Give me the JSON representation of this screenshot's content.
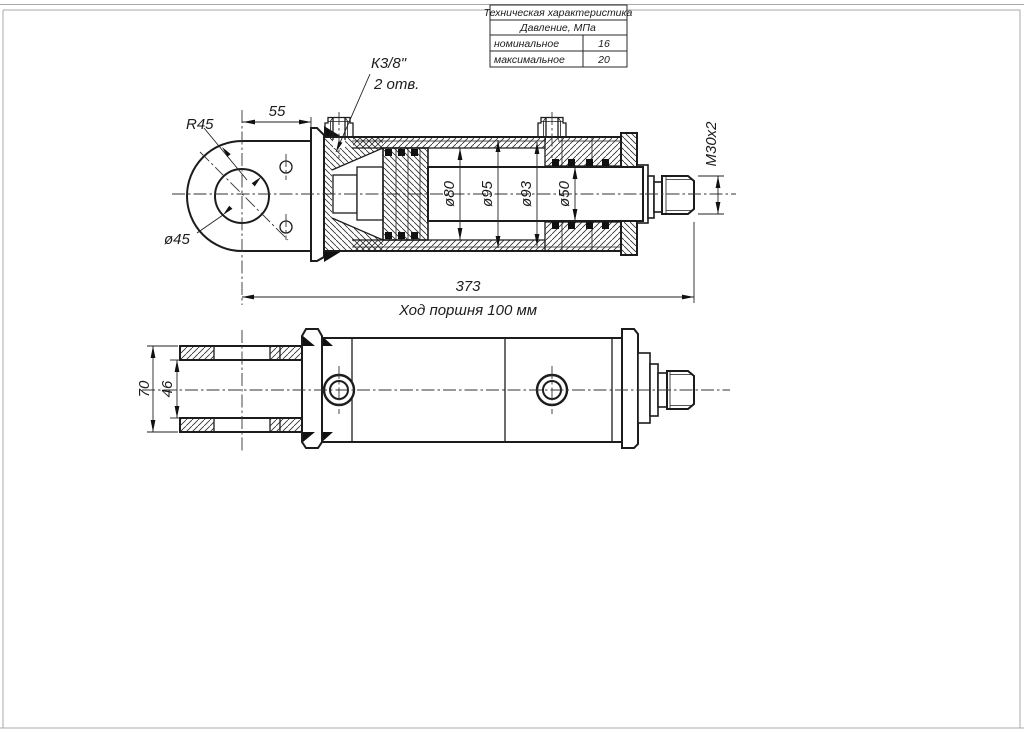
{
  "table": {
    "title": "Техническая характеристика",
    "subtitle": "Давление, МПа",
    "rows": [
      {
        "label": "номинальное",
        "value": "16"
      },
      {
        "label": "максимальное",
        "value": "20"
      }
    ]
  },
  "labels": {
    "eye_radius": "R45",
    "dim_55": "55",
    "port_thread": "К3/8\"",
    "port_holes": "2 отв.",
    "eye_hole_dia": "ø45",
    "bore_dia": "ø80",
    "tube_dia_95": "ø95",
    "tube_dia_93": "ø93",
    "rod_dia": "ø50",
    "rod_thread": "M30x2",
    "overall_length": "373",
    "stroke_note": "Ход поршня 100 мм",
    "fork_width_outer": "70",
    "fork_width_inner": "46"
  }
}
